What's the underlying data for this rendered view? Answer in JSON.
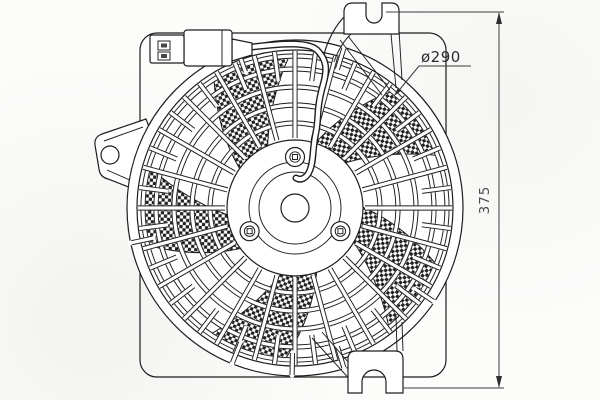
{
  "drawing": {
    "type": "technical-part-diagram",
    "dimensions": {
      "diameter_label": "ø290",
      "height_label": "375"
    },
    "colors": {
      "line": "#1d1d1d",
      "dimension_line": "#3c3c3c",
      "paper": "#fcfcfb"
    }
  }
}
